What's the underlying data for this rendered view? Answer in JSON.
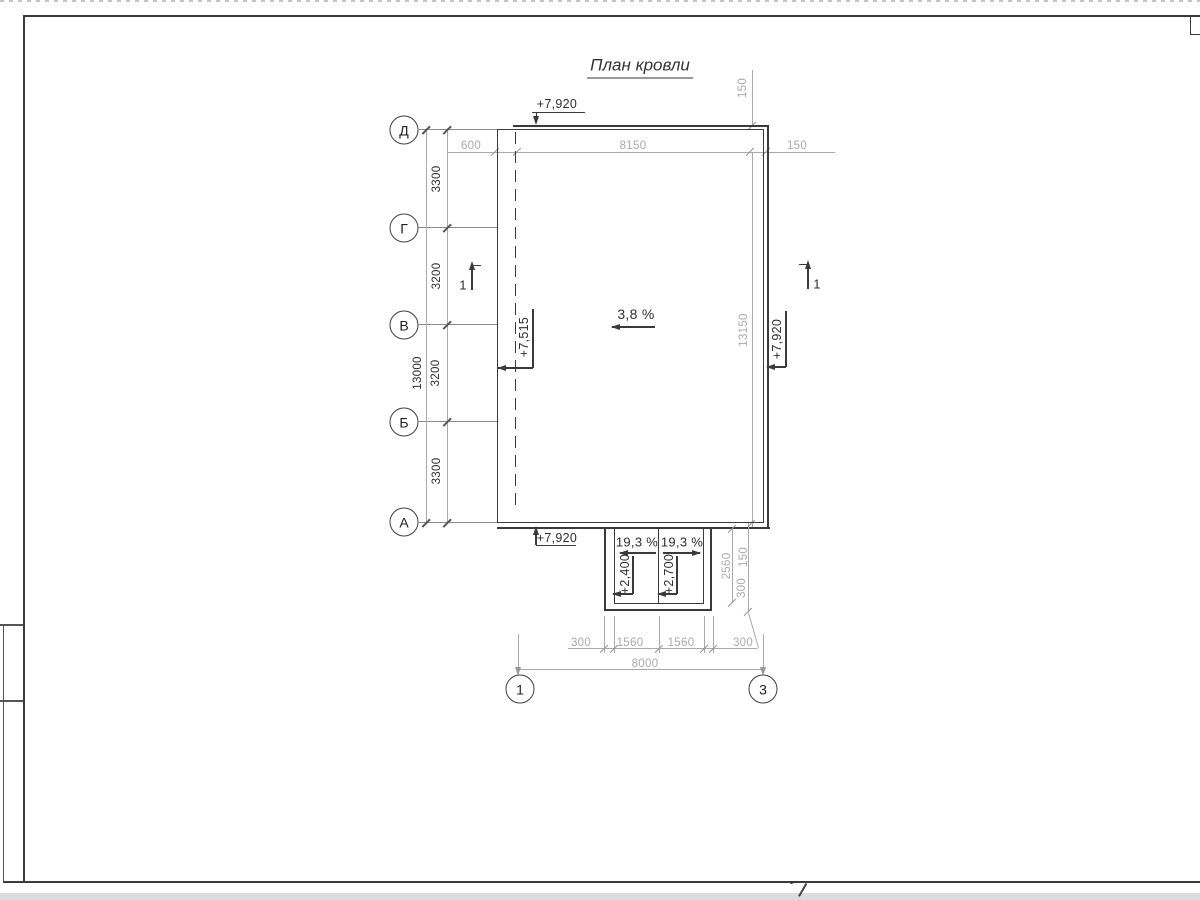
{
  "sheet": {
    "title": "План кровли"
  },
  "grid": {
    "rows": [
      "Д",
      "Г",
      "В",
      "Б",
      "А"
    ],
    "cols": [
      "1",
      "3"
    ]
  },
  "dims": {
    "left_chain": [
      "3300",
      "3200",
      "3200",
      "3300"
    ],
    "left_total": "13000",
    "top_chain": [
      "600",
      "8150",
      "150"
    ],
    "top_right_vertical": "150",
    "right_height": "13150",
    "canopy_side": [
      "2560",
      "150",
      "300"
    ],
    "bottom_chain": [
      "300",
      "1560",
      "1560",
      "300"
    ],
    "bottom_total": "8000"
  },
  "elevations": {
    "roof_top": "+7,920",
    "roof_left": "+7,515",
    "roof_right": "+7,920",
    "roof_bottom": "+7,920",
    "canopy_a": "+2,400",
    "canopy_b": "+2,700"
  },
  "slopes": {
    "main": "3,8 %",
    "canopy_left": "19,3 %",
    "canopy_right": "19,3 %"
  },
  "sections": {
    "left": "1",
    "right": "1"
  },
  "colors": {
    "line_dark": "#3a3a3a",
    "line_gray": "#a9a9a9"
  }
}
